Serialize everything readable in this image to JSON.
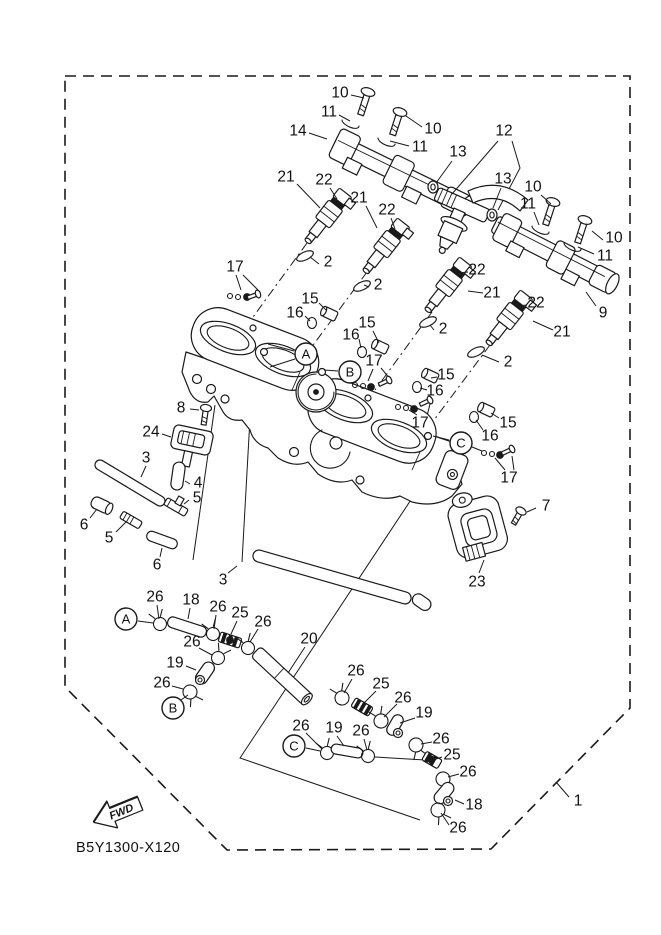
{
  "diagram": {
    "part_code": "B5Y1300-X120",
    "fwd_label": "FWD",
    "colors": {
      "ink": "#1a1a1a",
      "background": "#ffffff"
    },
    "callouts": [
      {
        "text": "10",
        "x": 340,
        "y": 93,
        "leader": [
          351,
          95,
          364,
          98
        ]
      },
      {
        "text": "11",
        "x": 329,
        "y": 112,
        "leader": [
          339,
          115,
          350,
          121
        ]
      },
      {
        "text": "14",
        "x": 298,
        "y": 131,
        "leader": [
          309,
          133,
          327,
          139
        ]
      },
      {
        "text": "10",
        "x": 433,
        "y": 129,
        "leader": [
          422,
          127,
          406,
          116
        ]
      },
      {
        "text": "11",
        "x": 420,
        "y": 147,
        "leader": [
          409,
          146,
          390,
          141
        ]
      },
      {
        "text": "13",
        "x": 458,
        "y": 152,
        "leader": [
          452,
          161,
          436,
          183
        ]
      },
      {
        "text": "12",
        "x": 504,
        "y": 131,
        "leader": [
          498,
          141,
          452,
          194
        ]
      },
      {
        "text": "13",
        "x": 503,
        "y": 179,
        "leader": [
          501,
          188,
          493,
          208
        ]
      },
      {
        "text": "10",
        "x": 533,
        "y": 187,
        "leader": [
          541,
          195,
          551,
          204
        ]
      },
      {
        "text": "11",
        "x": 528,
        "y": 204,
        "leader": [
          534,
          212,
          539,
          225
        ]
      },
      {
        "text": "10",
        "x": 614,
        "y": 238,
        "leader": [
          603,
          240,
          592,
          231
        ]
      },
      {
        "text": "11",
        "x": 605,
        "y": 256,
        "leader": [
          594,
          254,
          578,
          247
        ]
      },
      {
        "text": "9",
        "x": 603,
        "y": 313,
        "leader": [
          596,
          306,
          586,
          292
        ]
      },
      {
        "text": "21",
        "x": 286,
        "y": 177,
        "leader": [
          297,
          184,
          320,
          208
        ]
      },
      {
        "text": "22",
        "x": 324,
        "y": 180,
        "leader": [
          330,
          188,
          337,
          199
        ]
      },
      {
        "text": "21",
        "x": 359,
        "y": 198,
        "leader": [
          366,
          206,
          377,
          228
        ]
      },
      {
        "text": "22",
        "x": 387,
        "y": 210,
        "leader": [
          391,
          218,
          395,
          229
        ]
      },
      {
        "text": "22",
        "x": 477,
        "y": 270,
        "leader": [
          468,
          272,
          459,
          273
        ]
      },
      {
        "text": "21",
        "x": 492,
        "y": 293,
        "leader": [
          483,
          293,
          468,
          291
        ]
      },
      {
        "text": "22",
        "x": 536,
        "y": 303,
        "leader": [
          527,
          305,
          517,
          306
        ]
      },
      {
        "text": "21",
        "x": 562,
        "y": 332,
        "leader": [
          553,
          330,
          533,
          321
        ]
      },
      {
        "text": "2",
        "x": 328,
        "y": 262,
        "leader": [
          319,
          264,
          310,
          257
        ]
      },
      {
        "text": "2",
        "x": 378,
        "y": 285,
        "leader": [
          369,
          287,
          364,
          285
        ]
      },
      {
        "text": "2",
        "x": 443,
        "y": 329,
        "leader": [
          434,
          330,
          430,
          325
        ]
      },
      {
        "text": "2",
        "x": 508,
        "y": 362,
        "leader": [
          499,
          362,
          482,
          355
        ]
      },
      {
        "text": "17",
        "x": 235,
        "y": 267,
        "leader": [
          236,
          275,
          241,
          290
        ]
      },
      {
        "text": "15",
        "x": 310,
        "y": 299,
        "leader": [
          319,
          303,
          326,
          310
        ]
      },
      {
        "text": "16",
        "x": 295,
        "y": 313,
        "leader": [
          305,
          316,
          310,
          321
        ]
      },
      {
        "text": "15",
        "x": 367,
        "y": 323,
        "leader": [
          373,
          331,
          379,
          343
        ]
      },
      {
        "text": "16",
        "x": 351,
        "y": 335,
        "leader": [
          359,
          339,
          361,
          348
        ]
      },
      {
        "text": "17",
        "x": 374,
        "y": 361,
        "leader": [
          373,
          369,
          368,
          381
        ]
      },
      {
        "text": "15",
        "x": 446,
        "y": 375,
        "leader": [
          437,
          377,
          431,
          378
        ]
      },
      {
        "text": "16",
        "x": 435,
        "y": 391,
        "leader": [
          427,
          390,
          420,
          388
        ]
      },
      {
        "text": "17",
        "x": 420,
        "y": 423,
        "leader": [
          417,
          415,
          409,
          410
        ]
      },
      {
        "text": "15",
        "x": 508,
        "y": 423,
        "leader": [
          499,
          418,
          491,
          413
        ]
      },
      {
        "text": "16",
        "x": 490,
        "y": 436,
        "leader": [
          483,
          430,
          476,
          420
        ]
      },
      {
        "text": "17",
        "x": 509,
        "y": 478,
        "leader": [
          505,
          470,
          495,
          458
        ]
      },
      {
        "text": "8",
        "x": 181,
        "y": 408,
        "leader": [
          190,
          409,
          199,
          410
        ]
      },
      {
        "text": "24",
        "x": 151,
        "y": 432,
        "leader": [
          162,
          434,
          171,
          437
        ]
      },
      {
        "text": "3",
        "x": 146,
        "y": 458,
        "leader": [
          146,
          466,
          141,
          477
        ]
      },
      {
        "text": "4",
        "x": 198,
        "y": 483,
        "leader": [
          190,
          484,
          185,
          481
        ]
      },
      {
        "text": "5",
        "x": 197,
        "y": 498,
        "leader": [
          189,
          500,
          184,
          504
        ]
      },
      {
        "text": "6",
        "x": 84,
        "y": 525,
        "leader": [
          90,
          518,
          97,
          509
        ]
      },
      {
        "text": "5",
        "x": 109,
        "y": 538,
        "leader": [
          116,
          532,
          126,
          522
        ]
      },
      {
        "text": "6",
        "x": 157,
        "y": 565,
        "leader": [
          160,
          557,
          162,
          548
        ]
      },
      {
        "text": "3",
        "x": 223,
        "y": 580,
        "leader": [
          228,
          573,
          237,
          566
        ]
      },
      {
        "text": "7",
        "x": 546,
        "y": 506,
        "leader": [
          536,
          508,
          527,
          512
        ]
      },
      {
        "text": "23",
        "x": 477,
        "y": 582,
        "leader": [
          479,
          573,
          484,
          560
        ]
      },
      {
        "text": "1",
        "x": 578,
        "y": 801,
        "leader": [
          569,
          797,
          556,
          782
        ]
      },
      {
        "text": "26",
        "x": 155,
        "y": 597,
        "leader": [
          157,
          605,
          159,
          619
        ]
      },
      {
        "text": "18",
        "x": 191,
        "y": 600,
        "leader": [
          190,
          608,
          188,
          619
        ]
      },
      {
        "text": "26",
        "x": 218,
        "y": 607,
        "leader": [
          216,
          615,
          214,
          629
        ]
      },
      {
        "text": "25",
        "x": 240,
        "y": 613,
        "leader": [
          237,
          621,
          231,
          634
        ]
      },
      {
        "text": "26",
        "x": 263,
        "y": 622,
        "leader": [
          258,
          629,
          250,
          642
        ]
      },
      {
        "text": "26",
        "x": 192,
        "y": 642,
        "leader": [
          199,
          648,
          212,
          655
        ]
      },
      {
        "text": "19",
        "x": 175,
        "y": 663,
        "leader": [
          186,
          666,
          196,
          670
        ]
      },
      {
        "text": "26",
        "x": 162,
        "y": 683,
        "leader": [
          172,
          686,
          183,
          689
        ]
      },
      {
        "text": "20",
        "x": 309,
        "y": 639,
        "leader": [
          305,
          647,
          288,
          673
        ]
      },
      {
        "text": "26",
        "x": 356,
        "y": 671,
        "leader": [
          352,
          679,
          344,
          693
        ]
      },
      {
        "text": "25",
        "x": 381,
        "y": 684,
        "leader": [
          376,
          691,
          364,
          703
        ]
      },
      {
        "text": "26",
        "x": 403,
        "y": 698,
        "leader": [
          397,
          704,
          384,
          717
        ]
      },
      {
        "text": "19",
        "x": 424,
        "y": 713,
        "leader": [
          415,
          718,
          400,
          723
        ]
      },
      {
        "text": "26",
        "x": 441,
        "y": 739,
        "leader": [
          432,
          742,
          421,
          744
        ]
      },
      {
        "text": "25",
        "x": 452,
        "y": 755,
        "leader": [
          442,
          757,
          436,
          759
        ]
      },
      {
        "text": "26",
        "x": 468,
        "y": 772,
        "leader": [
          459,
          774,
          448,
          777
        ]
      },
      {
        "text": "18",
        "x": 474,
        "y": 805,
        "leader": [
          464,
          804,
          455,
          800
        ]
      },
      {
        "text": "26",
        "x": 458,
        "y": 828,
        "leader": [
          449,
          825,
          441,
          813
        ]
      },
      {
        "text": "26",
        "x": 301,
        "y": 726,
        "leader": [
          306,
          733,
          322,
          749
        ]
      },
      {
        "text": "19",
        "x": 334,
        "y": 728,
        "leader": [
          337,
          736,
          344,
          746
        ]
      },
      {
        "text": "26",
        "x": 361,
        "y": 731,
        "leader": [
          364,
          739,
          367,
          750
        ]
      }
    ],
    "balloons": [
      {
        "letter": "A",
        "x": 306,
        "y": 354,
        "r": 11,
        "leaders": [
          [
            294,
            351,
            268,
            344
          ],
          [
            295,
            359,
            270,
            367
          ]
        ]
      },
      {
        "letter": "B",
        "x": 350,
        "y": 372,
        "r": 11,
        "leaders": [
          [
            338,
            371,
            324,
            370
          ]
        ]
      },
      {
        "letter": "C",
        "x": 461,
        "y": 443,
        "r": 11,
        "leaders": [
          [
            449,
            440,
            433,
            436
          ],
          [
            472,
            447,
            482,
            451
          ]
        ]
      },
      {
        "letter": "A",
        "x": 126,
        "y": 619,
        "r": 11,
        "leaders": [
          [
            138,
            621,
            153,
            623
          ]
        ]
      },
      {
        "letter": "B",
        "x": 173,
        "y": 708,
        "r": 11,
        "leaders": [
          [
            181,
            700,
            188,
            695
          ]
        ]
      },
      {
        "letter": "C",
        "x": 294,
        "y": 746,
        "r": 11,
        "leaders": [
          [
            306,
            748,
            320,
            751
          ]
        ]
      }
    ],
    "construction_lines": [
      {
        "points": [
          436,
          462,
          240,
          758,
          420,
          820
        ],
        "style": "solid"
      },
      {
        "points": [
          215,
          405,
          193,
          560
        ],
        "style": "solid"
      },
      {
        "points": [
          250,
          418,
          242,
          562
        ],
        "style": "solid"
      },
      {
        "points": [
          375,
          757,
          425,
          760
        ],
        "style": "solid"
      },
      {
        "points": [
          512,
          141,
          520,
          168,
          498,
          210
        ],
        "style": "solid"
      },
      {
        "points": [
          243,
          275,
          259,
          291
        ],
        "style": "solid"
      },
      {
        "points": [
          381,
          368,
          390,
          379
        ],
        "style": "solid"
      },
      {
        "points": [
          427,
          416,
          430,
          404
        ],
        "style": "solid"
      },
      {
        "points": [
          514,
          470,
          512,
          456
        ],
        "style": "solid"
      },
      {
        "points": [
          307,
          243,
          245,
          328
        ],
        "style": "dashdot"
      },
      {
        "points": [
          367,
          272,
          308,
          352
        ],
        "style": "dashdot"
      },
      {
        "points": [
          432,
          312,
          375,
          390
        ],
        "style": "dashdot"
      },
      {
        "points": [
          490,
          345,
          434,
          420
        ],
        "style": "dashdot"
      }
    ]
  }
}
